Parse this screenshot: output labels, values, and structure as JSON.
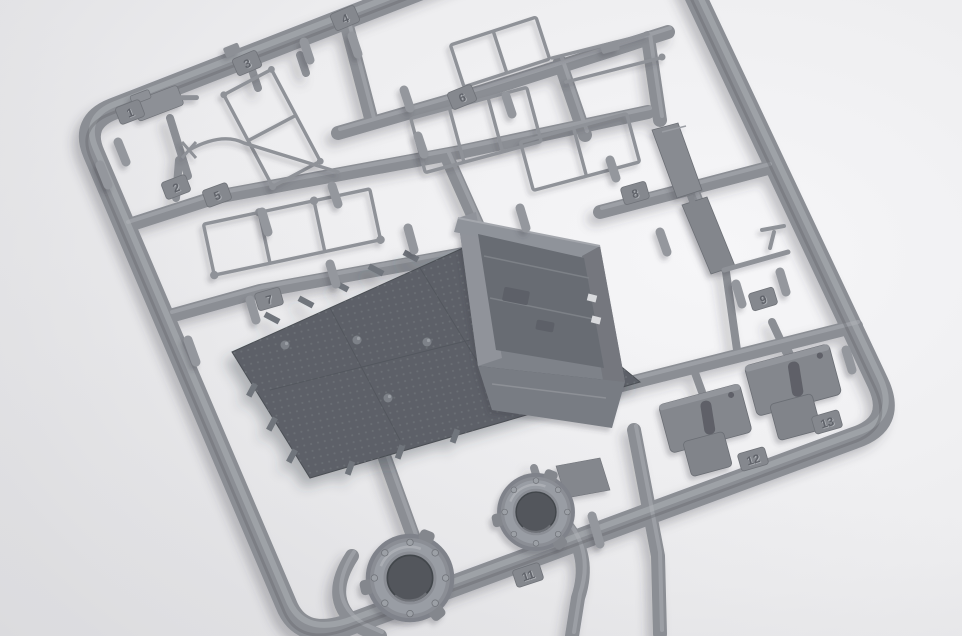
{
  "photo": {
    "subject": "Plastic model kit sprue",
    "description": "Light gray injection-molded styrene sprue (parts tree) for a military vehicle model kit, photographed at an angle on a white seamless background. The square runner frame holds a dark anti-slip-textured hull floor plate, an open superstructure tub, two bolted turret-ring discs, thin handrail frames, step brackets, a stowage plank and many small cylindrical parts.",
    "background_color": "#eeeef0",
    "plastic_color": "#8b8e94",
    "dark_plate_color": "#5d6167"
  },
  "part_tabs": [
    {
      "label": "1"
    },
    {
      "label": "2"
    },
    {
      "label": "3"
    },
    {
      "label": "4"
    },
    {
      "label": "5"
    },
    {
      "label": "6"
    },
    {
      "label": "7"
    },
    {
      "label": "8"
    },
    {
      "label": "9"
    },
    {
      "label": "11"
    },
    {
      "label": "12"
    },
    {
      "label": "13"
    }
  ],
  "visible_parts": [
    "runner frame",
    "hull floor plate with anti-slip texture",
    "superstructure tub",
    "large turret ring",
    "small turret ring with hatch flap",
    "handrail frames",
    "step brackets",
    "stowage plank",
    "pioneer tool rod",
    "small cylinders and dampers"
  ]
}
